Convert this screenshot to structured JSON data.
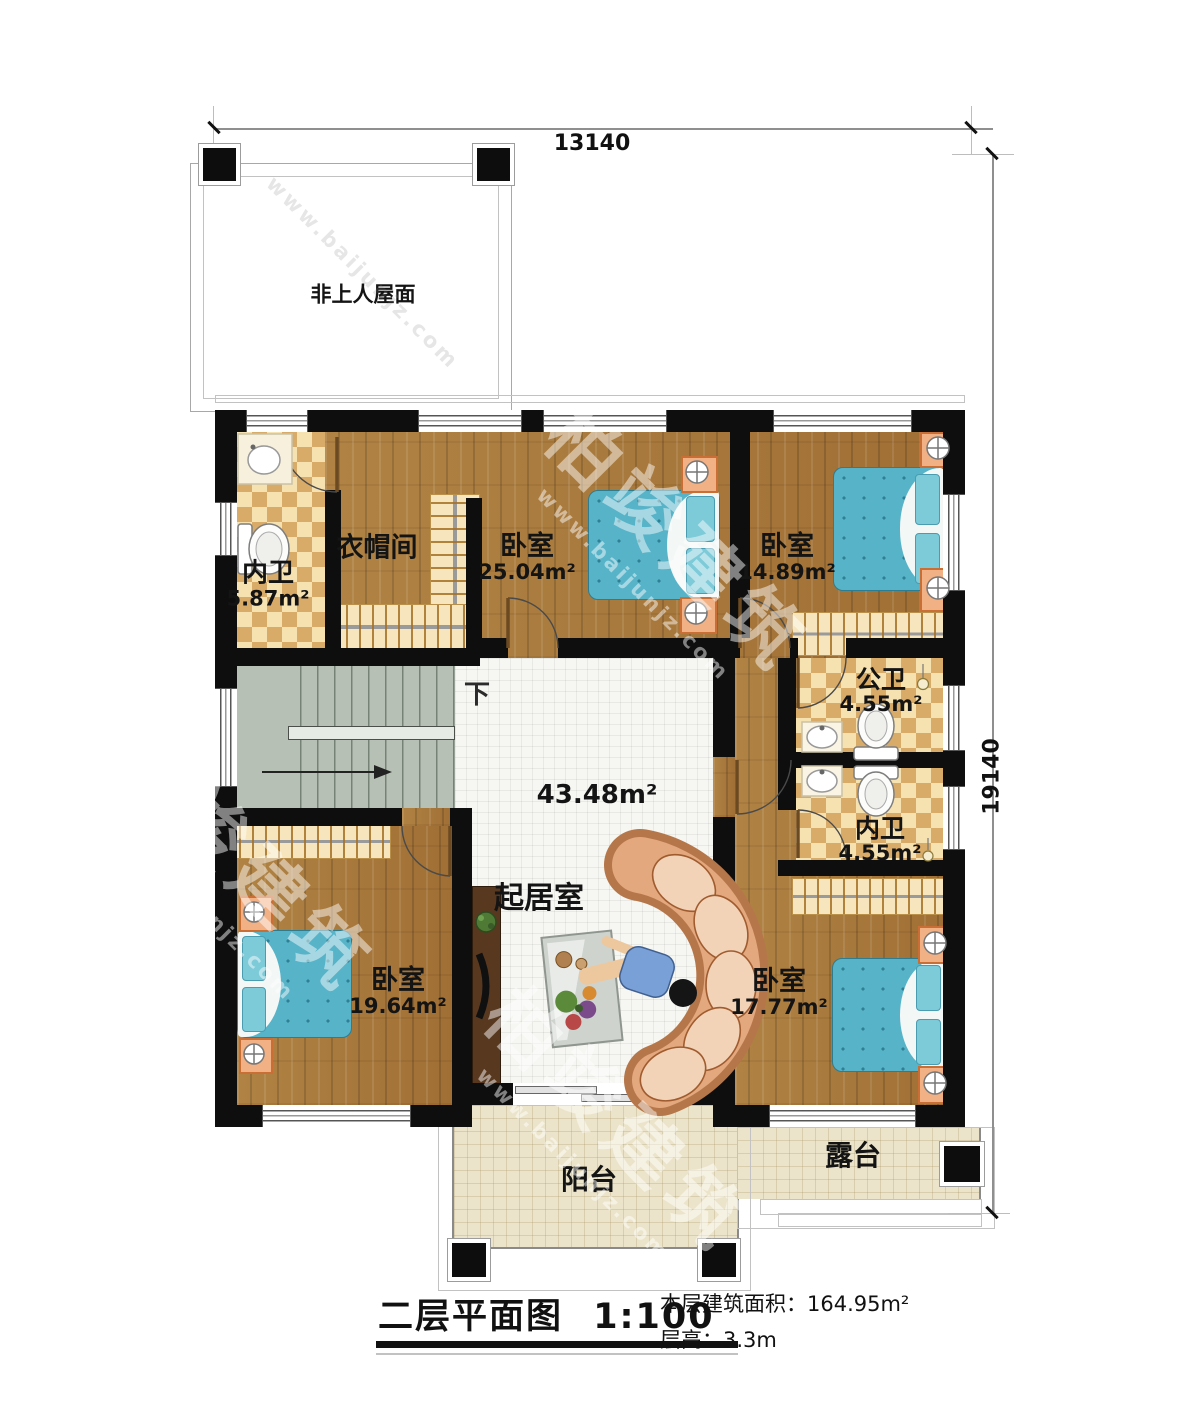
{
  "dimensions": {
    "top": "13140",
    "right": "19140"
  },
  "roof": {
    "label": "非上人屋面"
  },
  "stairs": {
    "down_label": "下"
  },
  "rooms": {
    "bath_top": {
      "name": "内卫",
      "area": "5.87m²"
    },
    "cloakroom": {
      "name": "衣帽间"
    },
    "bedroom_a": {
      "name": "卧室",
      "area": "25.04m²"
    },
    "bedroom_b": {
      "name": "卧室",
      "area": "14.89m²"
    },
    "public_bath": {
      "name": "公卫",
      "area": "4.55m²"
    },
    "inner_bath": {
      "name": "内卫",
      "area": "4.55m²"
    },
    "living": {
      "name": "起居室",
      "area": "43.48m²"
    },
    "bedroom_c": {
      "name": "卧室",
      "area": "19.64m²"
    },
    "bedroom_d": {
      "name": "卧室",
      "area": "17.77m²"
    },
    "balcony": {
      "name": "阳台"
    },
    "terrace": {
      "name": "露台"
    }
  },
  "footer": {
    "title": "二层平面图",
    "scale": "1:100",
    "area_label": "本层建筑面积：",
    "area_value": "164.95m²",
    "height_label": "层高：",
    "height_value": "3.3m"
  },
  "watermark": {
    "brand": "柏竣建筑",
    "url": "www.baijunjz.com"
  }
}
